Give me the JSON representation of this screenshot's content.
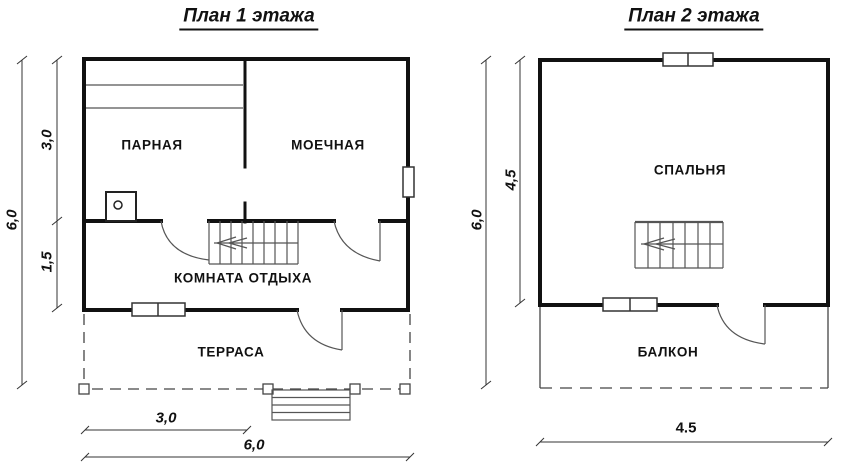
{
  "floor1": {
    "title": "План 1 этажа",
    "rooms": {
      "steam_room": "ПАРНАЯ",
      "washing_room": "МОЕЧНАЯ",
      "rest_room": "КОМНАТА ОТДЫХА",
      "terrace": "ТЕРРАСА"
    },
    "dimensions": {
      "left_total": "6,0",
      "left_upper": "3,0",
      "left_lower": "1,5",
      "bottom_partial": "3,0",
      "bottom_total": "6,0"
    }
  },
  "floor2": {
    "title": "План 2 этажа",
    "rooms": {
      "bedroom": "СПАЛЬНЯ",
      "balcony": "БАЛКОН"
    },
    "dimensions": {
      "left_total": "6,0",
      "left_room": "4,5",
      "bottom_width": "4.5"
    }
  },
  "icons": {
    "stairs": "stairs-with-direction-arrow",
    "stove": "stove-icon",
    "door": "door-swing-arc",
    "window": "window-symbol"
  },
  "colors": {
    "wall": "#111111",
    "thin_line": "#555555",
    "dimension_line": "#333333",
    "background": "#ffffff"
  }
}
